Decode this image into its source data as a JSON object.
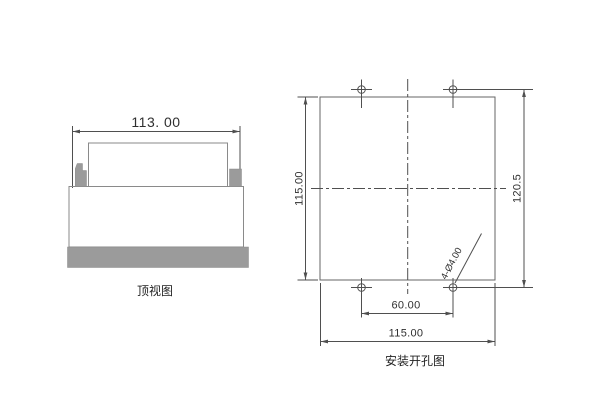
{
  "colors": {
    "geo": "#8a8a8a",
    "sq": "#666666",
    "dim": "#4f4f4f",
    "fillgray": "#9b9b9b",
    "text": "#2f2f2f"
  },
  "top_view": {
    "caption": "顶视图",
    "dims": {
      "width": "113. 00"
    }
  },
  "cutout_view": {
    "caption": "安装开孔图",
    "dims": {
      "cutout_height": "115.00",
      "hole_vertical_span": "120.5",
      "hole_horizontal_span": "60.00",
      "cutout_width": "115.00",
      "holes": "4-Ø4.00"
    }
  }
}
